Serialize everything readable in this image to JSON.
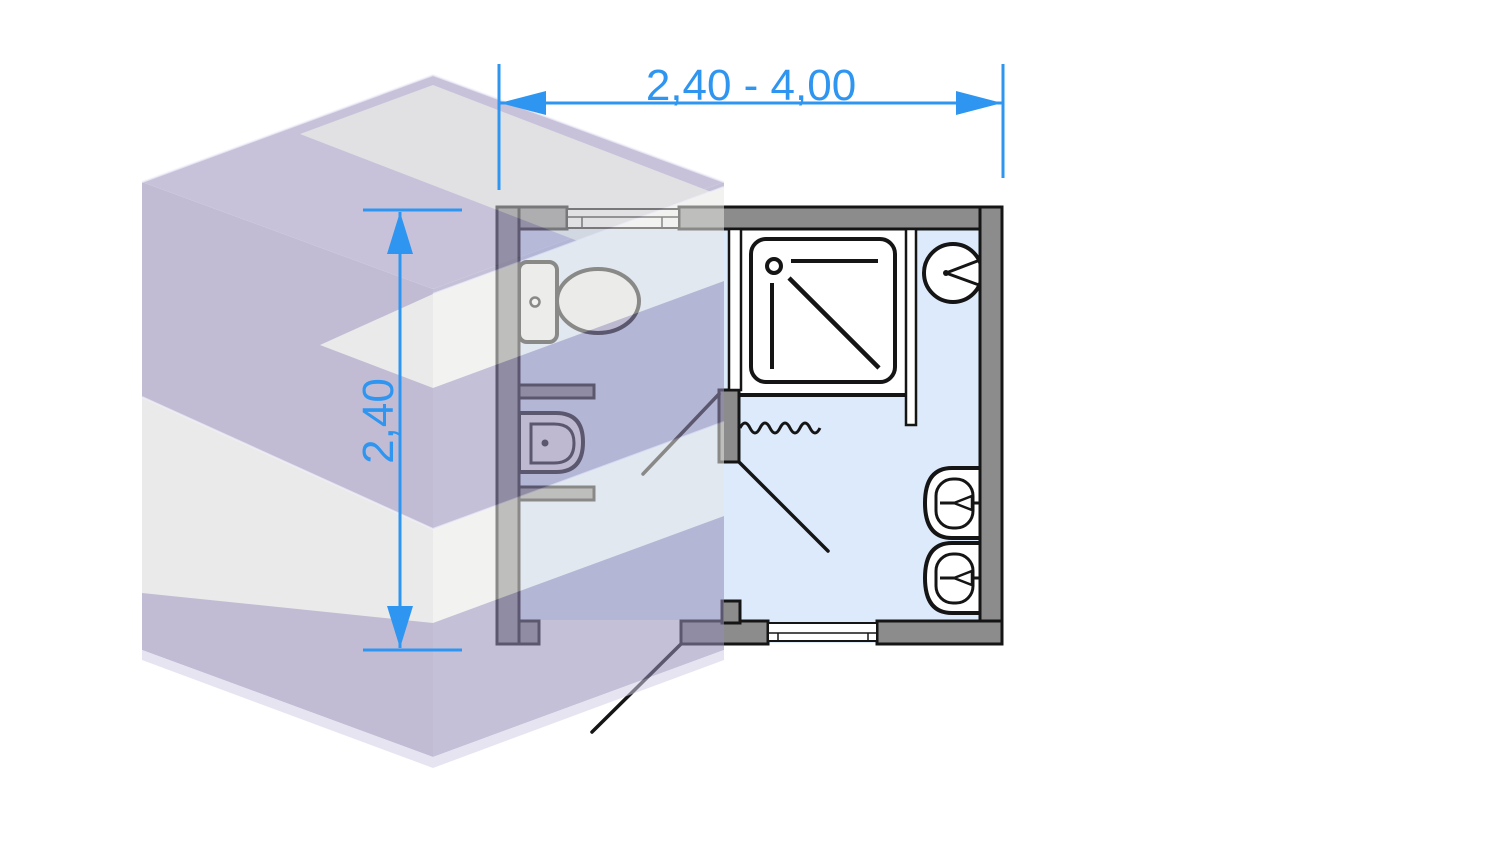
{
  "diagram": {
    "type": "bathroom-module-floor-plan",
    "width_label": "2,40 - 4,00",
    "height_label": "2,40"
  },
  "colors": {
    "dimension_blue": "#2E96F0",
    "wall_gray": "#8C8C8C",
    "outline_black": "#151515",
    "floor_blue": "#DCEAFB",
    "cube_lavender": "#8F87B2",
    "cube_white_band": "#D9D9D9",
    "cube_top_gray": "#CACACF",
    "background": "#FFFFFF"
  },
  "fixtures": [
    {
      "name": "toilet-icon"
    },
    {
      "name": "bidet-icon"
    },
    {
      "name": "shower-tray-icon"
    },
    {
      "name": "shower-curtain-icon"
    },
    {
      "name": "wall-light-icon"
    },
    {
      "name": "washbasin-icon"
    },
    {
      "name": "washbasin-icon"
    },
    {
      "name": "window-icon"
    },
    {
      "name": "window-icon"
    },
    {
      "name": "door-swing-icon"
    },
    {
      "name": "door-swing-icon"
    },
    {
      "name": "door-swing-icon"
    }
  ]
}
